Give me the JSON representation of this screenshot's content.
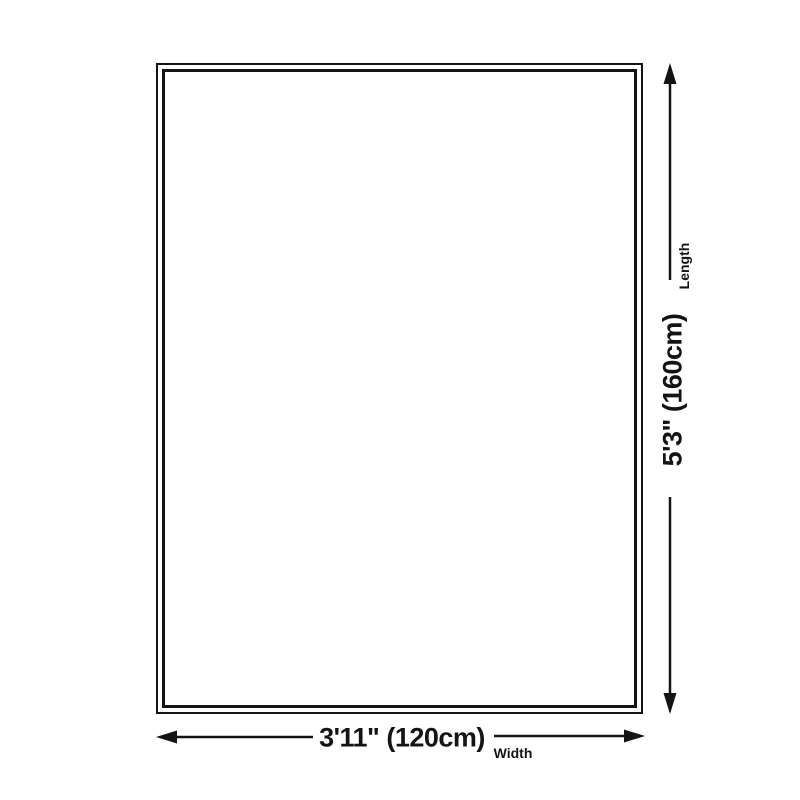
{
  "page": {
    "background": "#ffffff",
    "ink_color": "#141414"
  },
  "diagram": {
    "shape": "rug-outline-rectangle",
    "dimensions": {
      "length": {
        "value": "5'3\" (160cm)",
        "label": "Length"
      },
      "width": {
        "value": "3'11\" (120cm)",
        "label": "Width"
      }
    }
  }
}
